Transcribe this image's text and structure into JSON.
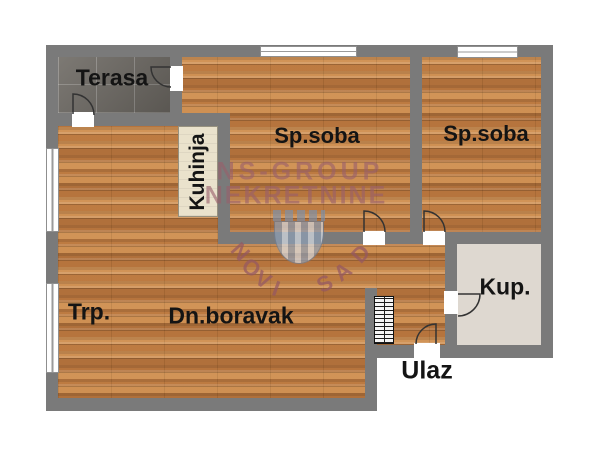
{
  "plan": {
    "type": "apartment-floor-plan"
  },
  "rooms": {
    "terasa": {
      "label": "Terasa"
    },
    "bedroom1": {
      "label": "Sp.soba"
    },
    "bedroom2": {
      "label": "Sp.soba"
    },
    "kitchen": {
      "label": "Kuhinja"
    },
    "dining": {
      "label": "Trp."
    },
    "living": {
      "label": "Dn.boravak"
    },
    "bathroom": {
      "label": "Kup."
    },
    "entrance": {
      "label": "Ulaz"
    }
  },
  "watermark": {
    "line1": "NS-GROUP",
    "line2": "NEKRETNINE",
    "arc_left": "NOVI",
    "arc_right": "SAD",
    "color": "#9a606a"
  },
  "colors": {
    "wall": "#7a7a7a",
    "wood_base": "#c4834a",
    "terrace_tile": "#6e6a64",
    "kitchen_counter": "#eae2cc",
    "label_text": "#141414",
    "bath_grout": "#ded8d0",
    "bath_palette": [
      "#7b7877",
      "#928e8c",
      "#a89f9a",
      "#8e7a74",
      "#6f625e",
      "#d98a66",
      "#c75f36",
      "#b8b2ae",
      "#84807e",
      "#97867f"
    ]
  }
}
